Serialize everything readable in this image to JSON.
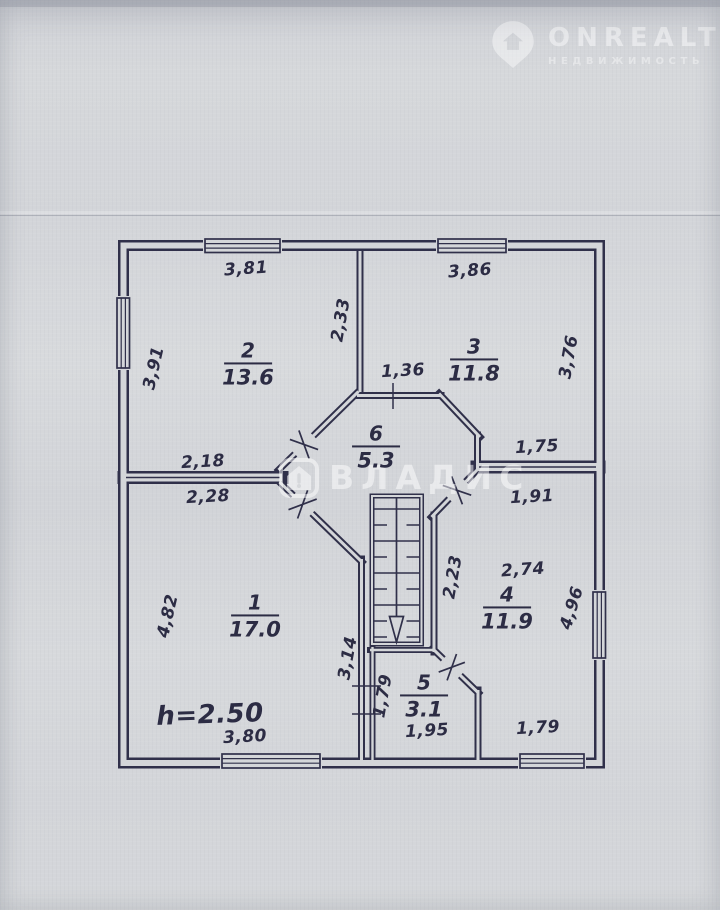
{
  "colors": {
    "ink": "#30304a",
    "paper": "#d4d6d9"
  },
  "watermarks": {
    "onrealt": {
      "brand": "ONREALT",
      "subtitle": "НЕДВИЖИМОСТЬ"
    },
    "vladis": {
      "brand": "ВЛАДИС"
    }
  },
  "plan": {
    "rooms": [
      {
        "number": "1",
        "area": "17.0",
        "x": 255,
        "y": 617
      },
      {
        "number": "2",
        "area": "13.6",
        "x": 248,
        "y": 365
      },
      {
        "number": "3",
        "area": "11.8",
        "x": 474,
        "y": 361
      },
      {
        "number": "4",
        "area": "11.9",
        "x": 507,
        "y": 609
      },
      {
        "number": "5",
        "area": "3.1",
        "x": 424,
        "y": 697
      },
      {
        "number": "6",
        "area": "5.3",
        "x": 376,
        "y": 448
      }
    ],
    "dimensions": [
      {
        "text": "3,81",
        "x": 246,
        "y": 269,
        "rot": -4
      },
      {
        "text": "3,86",
        "x": 470,
        "y": 271,
        "rot": -4
      },
      {
        "text": "3,91",
        "x": 154,
        "y": 368,
        "rot": -77
      },
      {
        "text": "2,33",
        "x": 341,
        "y": 320,
        "rot": -80
      },
      {
        "text": "3,76",
        "x": 569,
        "y": 357,
        "rot": -80
      },
      {
        "text": "1,36",
        "x": 403,
        "y": 371,
        "rot": -3
      },
      {
        "text": "2,18",
        "x": 203,
        "y": 462,
        "rot": -3
      },
      {
        "text": "2,28",
        "x": 208,
        "y": 497,
        "rot": -3
      },
      {
        "text": "1,75",
        "x": 537,
        "y": 447,
        "rot": -3
      },
      {
        "text": "1,91",
        "x": 532,
        "y": 497,
        "rot": -3
      },
      {
        "text": "2,74",
        "x": 523,
        "y": 570,
        "rot": -4
      },
      {
        "text": "2,23",
        "x": 453,
        "y": 577,
        "rot": -80
      },
      {
        "text": "4,82",
        "x": 168,
        "y": 616,
        "rot": -77
      },
      {
        "text": "4,96",
        "x": 572,
        "y": 608,
        "rot": -73
      },
      {
        "text": "3,14",
        "x": 348,
        "y": 658,
        "rot": -80
      },
      {
        "text": "1,79",
        "x": 383,
        "y": 696,
        "rot": -80
      },
      {
        "text": "1,95",
        "x": 427,
        "y": 731,
        "rot": -3
      },
      {
        "text": "3,80",
        "x": 245,
        "y": 737,
        "rot": -3
      },
      {
        "text": "1,79",
        "x": 538,
        "y": 728,
        "rot": -3
      },
      {
        "text": "h=2.50",
        "x": 210,
        "y": 715,
        "rot": -2,
        "kind": "height"
      }
    ]
  }
}
